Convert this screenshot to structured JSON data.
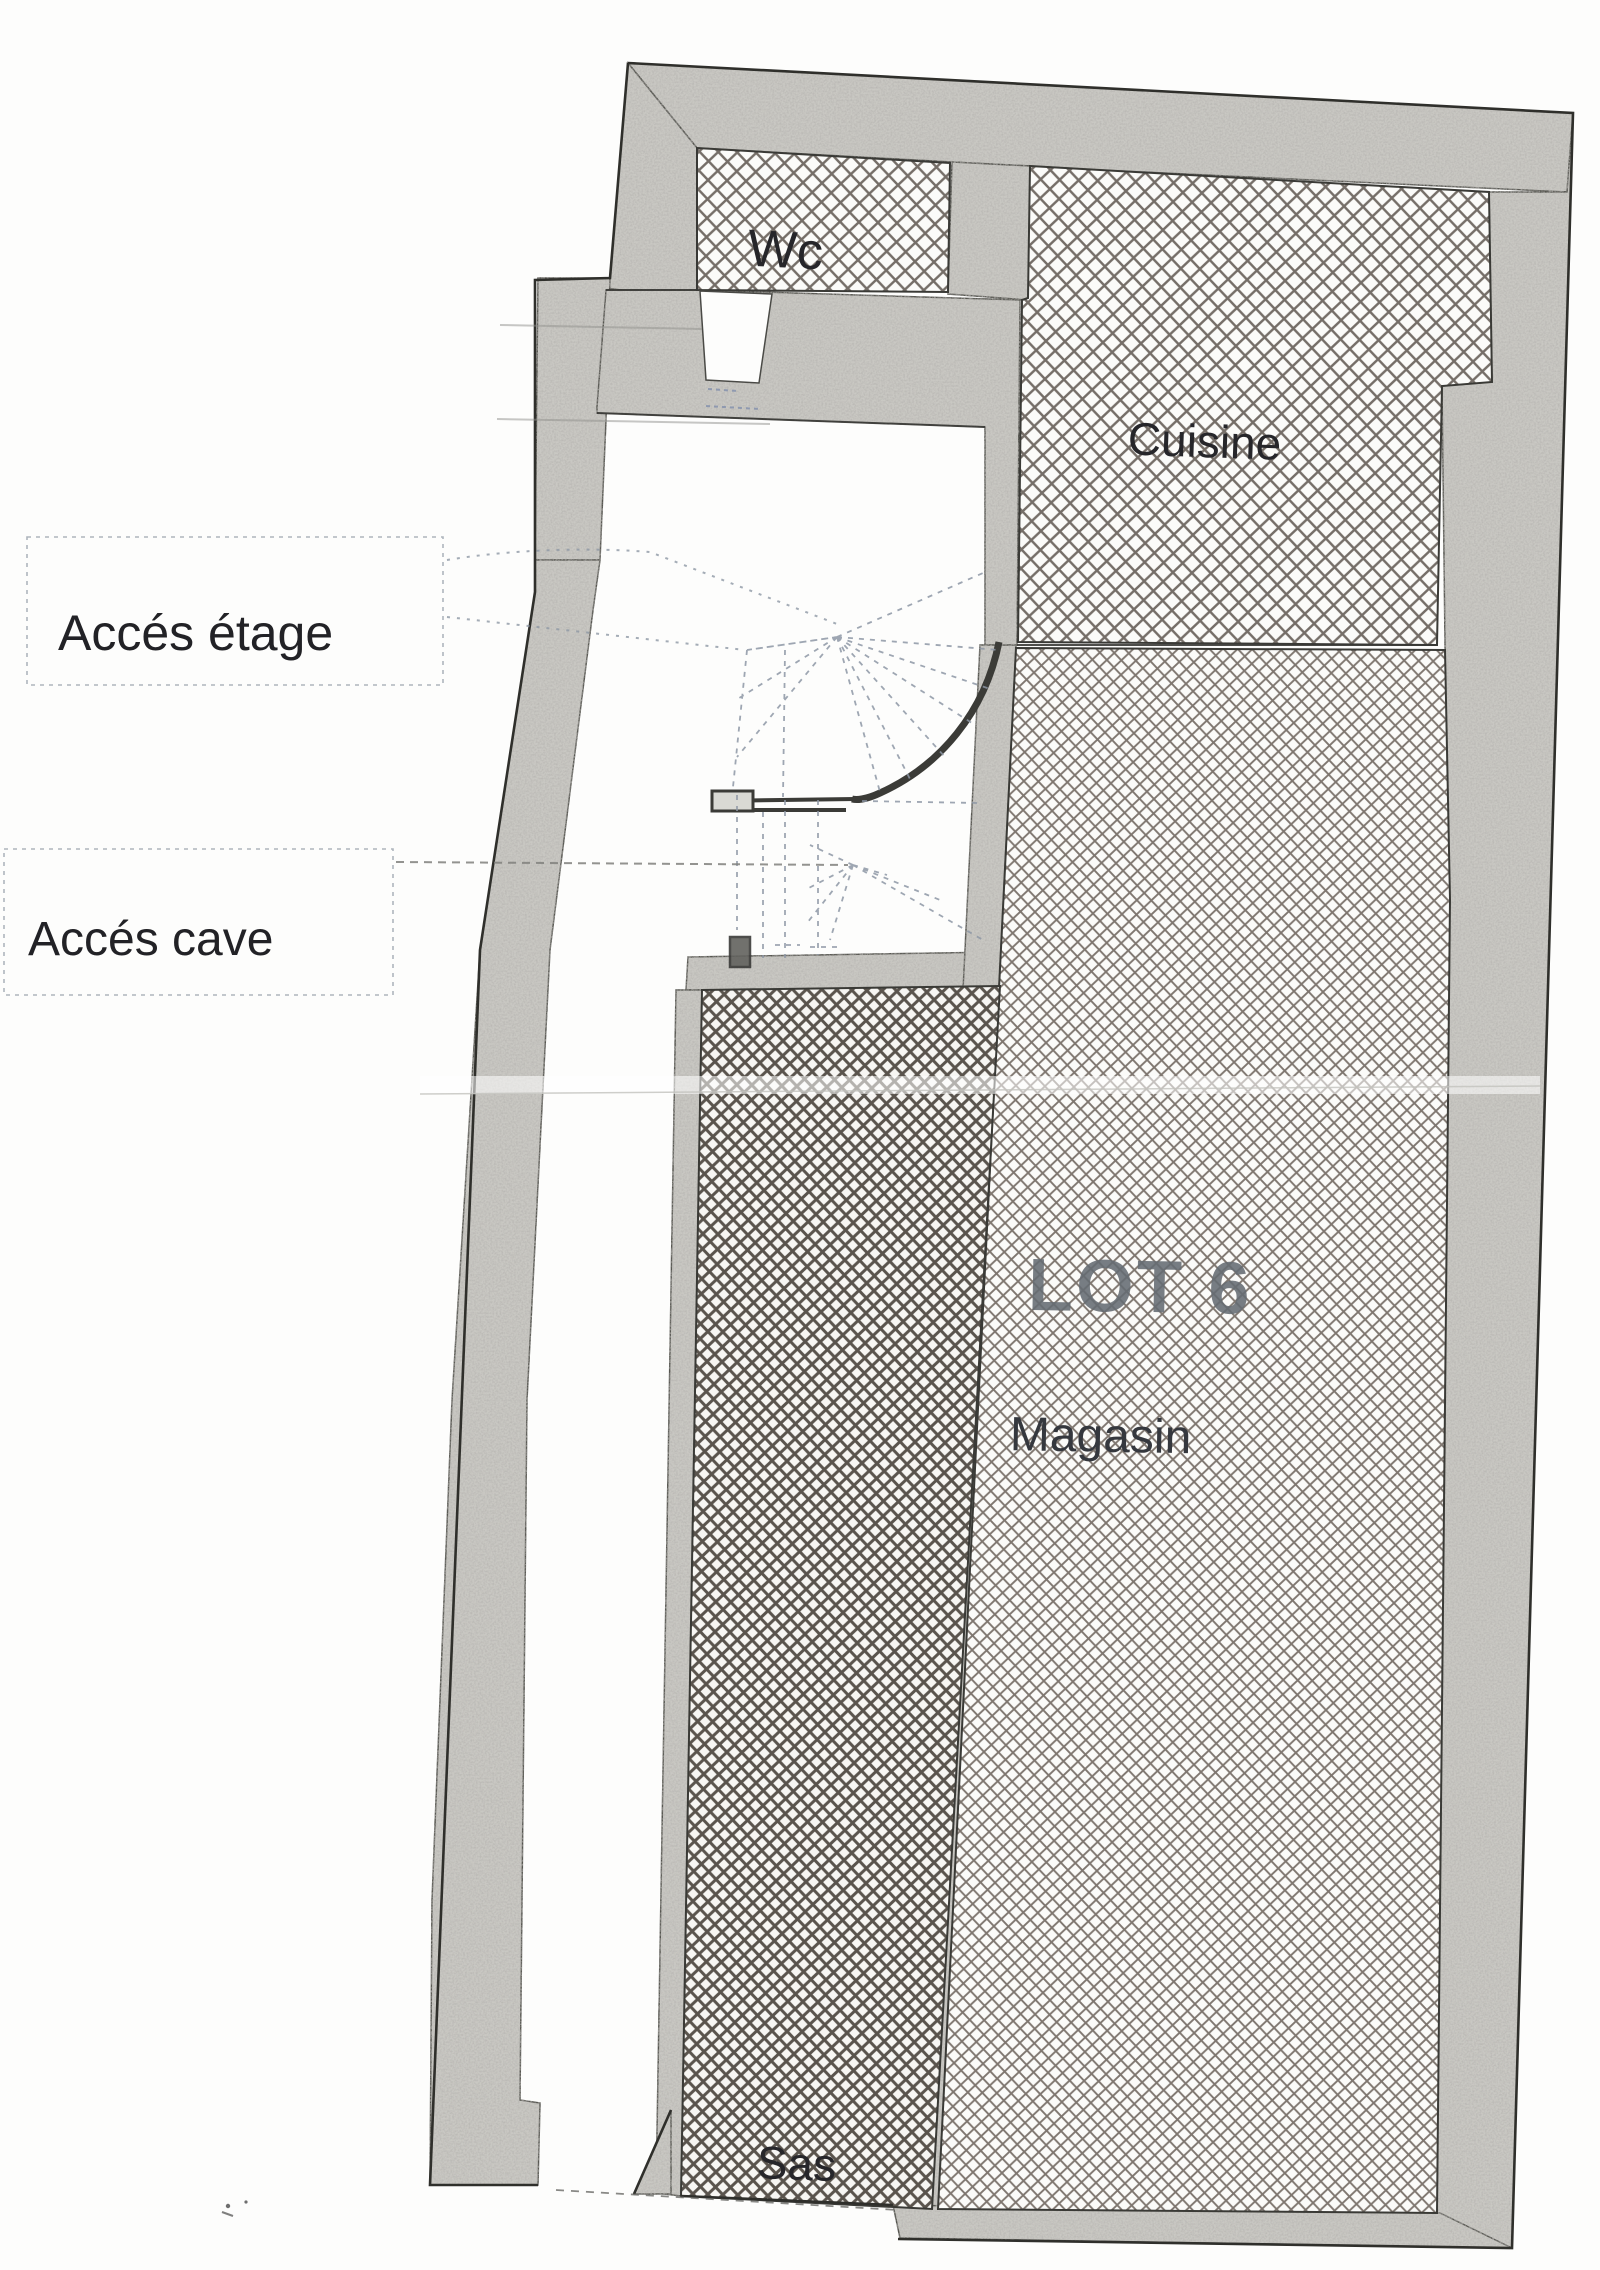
{
  "plan": {
    "rooms": [
      {
        "id": "wc",
        "label": "Wc"
      },
      {
        "id": "cuisine",
        "label": "Cuisine"
      },
      {
        "id": "magasin",
        "label": "Magasin"
      },
      {
        "id": "sas",
        "label": "Sas"
      }
    ],
    "lot": {
      "label": "LOT 6"
    },
    "annotations": [
      {
        "id": "acces-etage",
        "label": "Accés étage"
      },
      {
        "id": "acces-cave",
        "label": "Accés cave"
      }
    ],
    "colors": {
      "paper": "#fdfdfc",
      "wall_fill": "#c7c6c1",
      "hatch_light": "#5e564e",
      "hatch_medium": "#6a6058",
      "hatch_dark": "#49423a",
      "ink": "#2f2f2b",
      "lot_text": "#656c73",
      "leader": "#8d97a4"
    }
  }
}
